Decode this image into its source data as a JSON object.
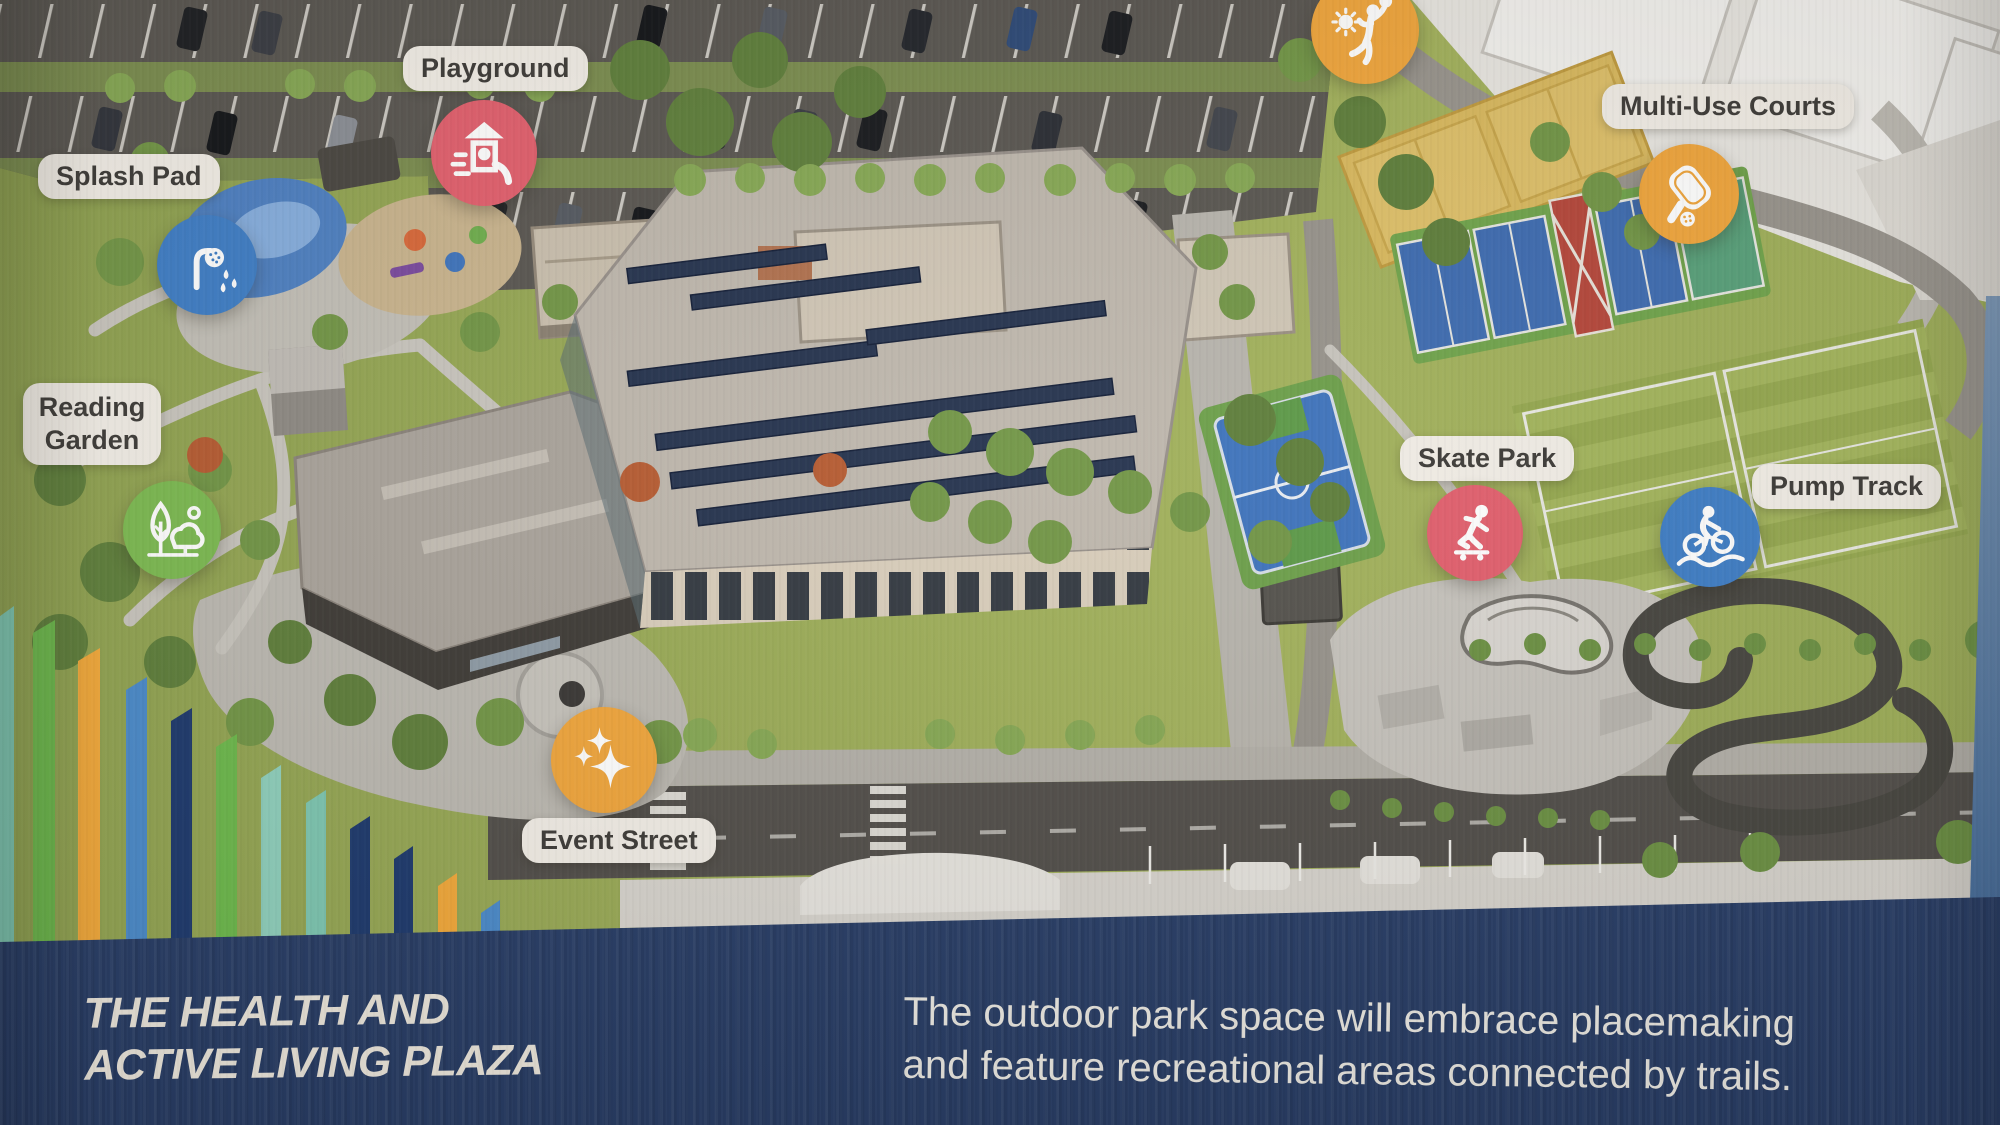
{
  "poster": {
    "banner": {
      "title_line1": "THE HEALTH AND",
      "title_line2": "ACTIVE LIVING PLAZA",
      "description_line1": "The outdoor park space will embrace placemaking",
      "description_line2": "and feature recreational areas connected by trails.",
      "background_color": "#2b4372",
      "text_color": "#ebe6dc"
    },
    "markers": [
      {
        "id": "playground",
        "label": "Playground",
        "color": "#e2606e",
        "icon": "playground-icon"
      },
      {
        "id": "splash-pad",
        "label": "Splash Pad",
        "color": "#3f7ec6",
        "icon": "splash-pad-icon"
      },
      {
        "id": "reading-garden",
        "label": "Reading Garden",
        "color": "#7cba52",
        "icon": "reading-garden-icon"
      },
      {
        "id": "sand-volleyball",
        "label": "",
        "color": "#f0a63d",
        "icon": "volleyball-player-icon"
      },
      {
        "id": "multi-use-courts",
        "label": "Multi-Use Courts",
        "color": "#f0a63d",
        "icon": "pickleball-paddle-icon"
      },
      {
        "id": "skate-park",
        "label": "Skate Park",
        "color": "#e2606e",
        "icon": "skateboarder-icon"
      },
      {
        "id": "pump-track",
        "label": "Pump Track",
        "color": "#3f7ec6",
        "icon": "cyclist-icon"
      },
      {
        "id": "event-street",
        "label": "Event Street",
        "color": "#f0a63d",
        "icon": "sparkles-icon"
      }
    ],
    "palette_bars": [
      "#7ec7b2",
      "#6db94d",
      "#f2a93b",
      "#4b8bcb",
      "#1e3a6e",
      "#6db94d",
      "#8fd0bd",
      "#7ec7b2",
      "#1e3a6e",
      "#1e3a6e",
      "#f2a93b",
      "#4b8bcb"
    ]
  }
}
